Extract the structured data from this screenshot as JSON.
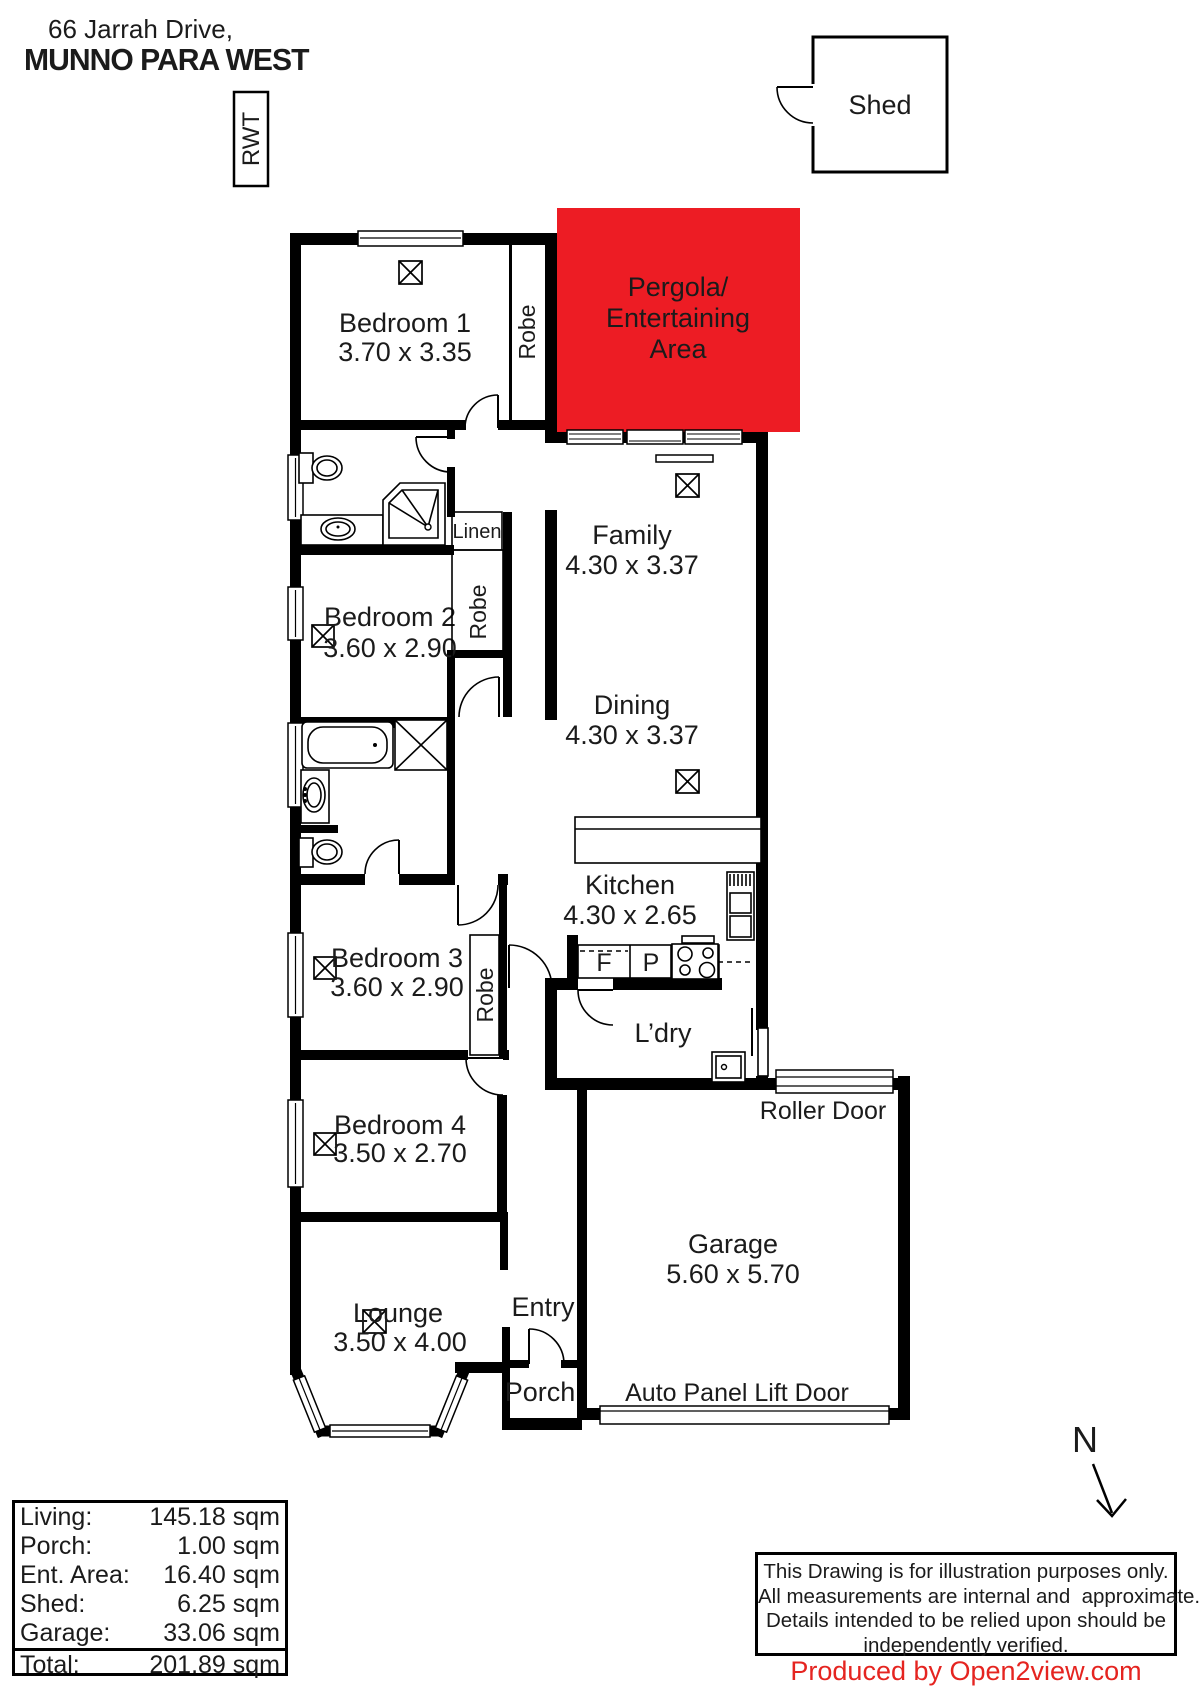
{
  "header": {
    "address_line1": "66 Jarrah Drive,",
    "address_line2": "MUNNO PARA WEST"
  },
  "plan": {
    "rwt_label": "RWT",
    "shed_label": "Shed",
    "pergola_line1": "Pergola/",
    "pergola_line2": "Entertaining",
    "pergola_line3": "Area",
    "pergola_color": "#ed1c24",
    "rooms": [
      {
        "name": "Bedroom 1",
        "dims": "3.70 x 3.35"
      },
      {
        "name": "Family",
        "dims": "4.30 x 3.37"
      },
      {
        "name": "Bedroom 2",
        "dims": "3.60 x 2.90"
      },
      {
        "name": "Dining",
        "dims": "4.30 x 3.37"
      },
      {
        "name": "Kitchen",
        "dims": "4.30 x 2.65"
      },
      {
        "name": "Bedroom 3",
        "dims": "3.60 x 2.90"
      },
      {
        "name": "Bedroom 4",
        "dims": "3.50 x 2.70"
      },
      {
        "name": "Lounge",
        "dims": "3.50 x 4.00"
      },
      {
        "name": "Garage",
        "dims": "5.60 x 5.70"
      }
    ],
    "labels": {
      "robe": "Robe",
      "linen": "Linen",
      "ldry": "L’dry",
      "entry": "Entry",
      "porch": "Porch",
      "roller_door": "Roller Door",
      "auto_door": "Auto Panel Lift Door",
      "fridge": "F",
      "pantry": "P",
      "north": "N"
    }
  },
  "area_table": {
    "rows": [
      {
        "label": "Living:",
        "value": "145.18 sqm"
      },
      {
        "label": "Porch:",
        "value": "1.00 sqm"
      },
      {
        "label": "Ent. Area:",
        "value": "16.40 sqm"
      },
      {
        "label": "Shed:",
        "value": "6.25 sqm"
      },
      {
        "label": "Garage:",
        "value": "33.06 sqm"
      }
    ],
    "total": {
      "label": "Total:",
      "value": "201.89 sqm"
    }
  },
  "disclaimer": {
    "line1": "This Drawing is for illustration purposes only.",
    "line2": "All measurements are internal and  approximate.",
    "line3": "Details intended to be relied upon should be",
    "line4": "independently verified."
  },
  "credit": {
    "text": "Produced by Open2view.com",
    "color": "#e52420"
  }
}
